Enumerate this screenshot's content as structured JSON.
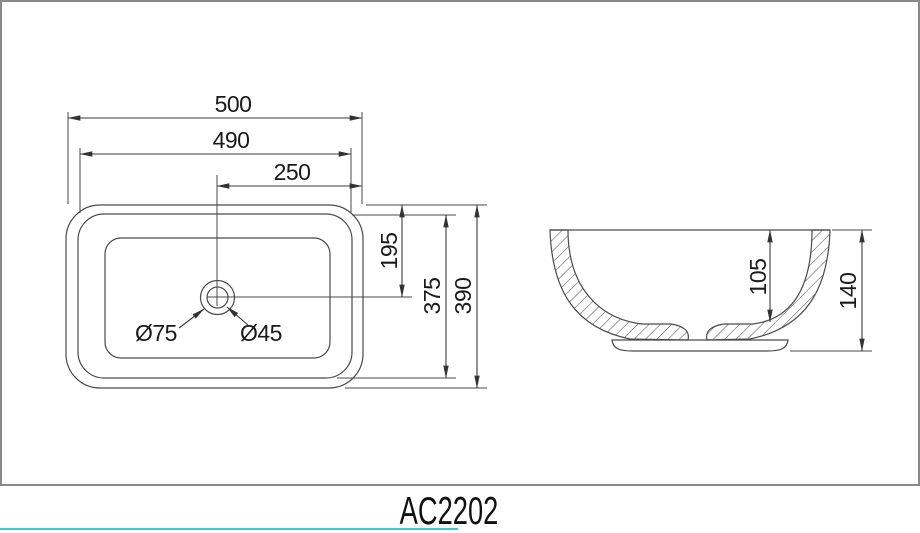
{
  "model_label": "AC2202",
  "top_view": {
    "overall_width": "500",
    "rim_width": "490",
    "drain_center_from_right": "250",
    "drain_center_from_top": "195",
    "rim_depth": "375",
    "overall_depth": "390",
    "drain_outer_diameter": "Ø75",
    "drain_hole_diameter": "Ø45"
  },
  "side_view": {
    "inner_depth": "105",
    "overall_height": "140"
  },
  "colors": {
    "line": "#4a4a4a",
    "text": "#1a1a1a",
    "panel_border": "#8a8a8a",
    "accent": "#3bc8d4"
  }
}
